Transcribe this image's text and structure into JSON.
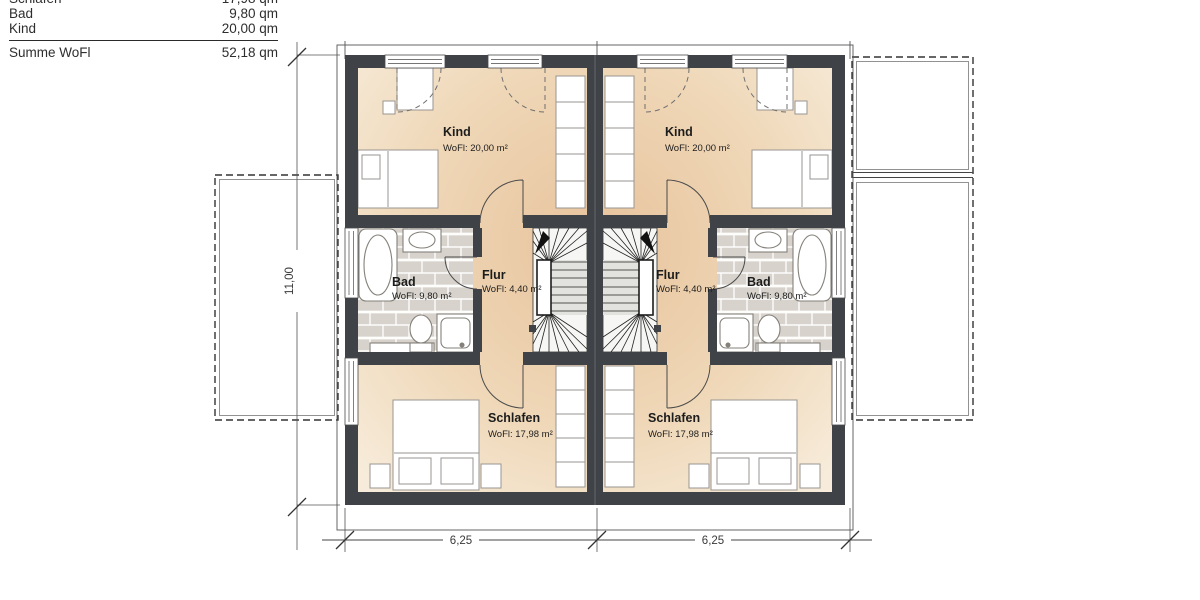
{
  "legend": {
    "rows": [
      {
        "label": "Schlafen",
        "value": "17,98 qm"
      },
      {
        "label": "Bad",
        "value": "9,80 qm"
      },
      {
        "label": "Kind",
        "value": "20,00 qm"
      }
    ],
    "total_label": "Summe WoFl",
    "total_value": "52,18 qm"
  },
  "rooms": {
    "kind": {
      "name": "Kind",
      "area": "WoFl: 20,00 m²"
    },
    "bad": {
      "name": "Bad",
      "area": "WoFl: 9,80 m²"
    },
    "flur": {
      "name": "Flur",
      "area": "WoFl: 4,40 m²"
    },
    "schlafen": {
      "name": "Schlafen",
      "area": "WoFl: 17,98 m²"
    }
  },
  "dimensions": {
    "overall_depth": "11,00",
    "unit_width_left": "6,25",
    "unit_width_right": "6,25"
  },
  "colors": {
    "wall": "#3f4347",
    "floor_light": "#f7ecdb",
    "floor_deep": "#e8c39c",
    "tile": "#d7d3cc",
    "annotation": "#444444",
    "paper": "#ffffff"
  }
}
